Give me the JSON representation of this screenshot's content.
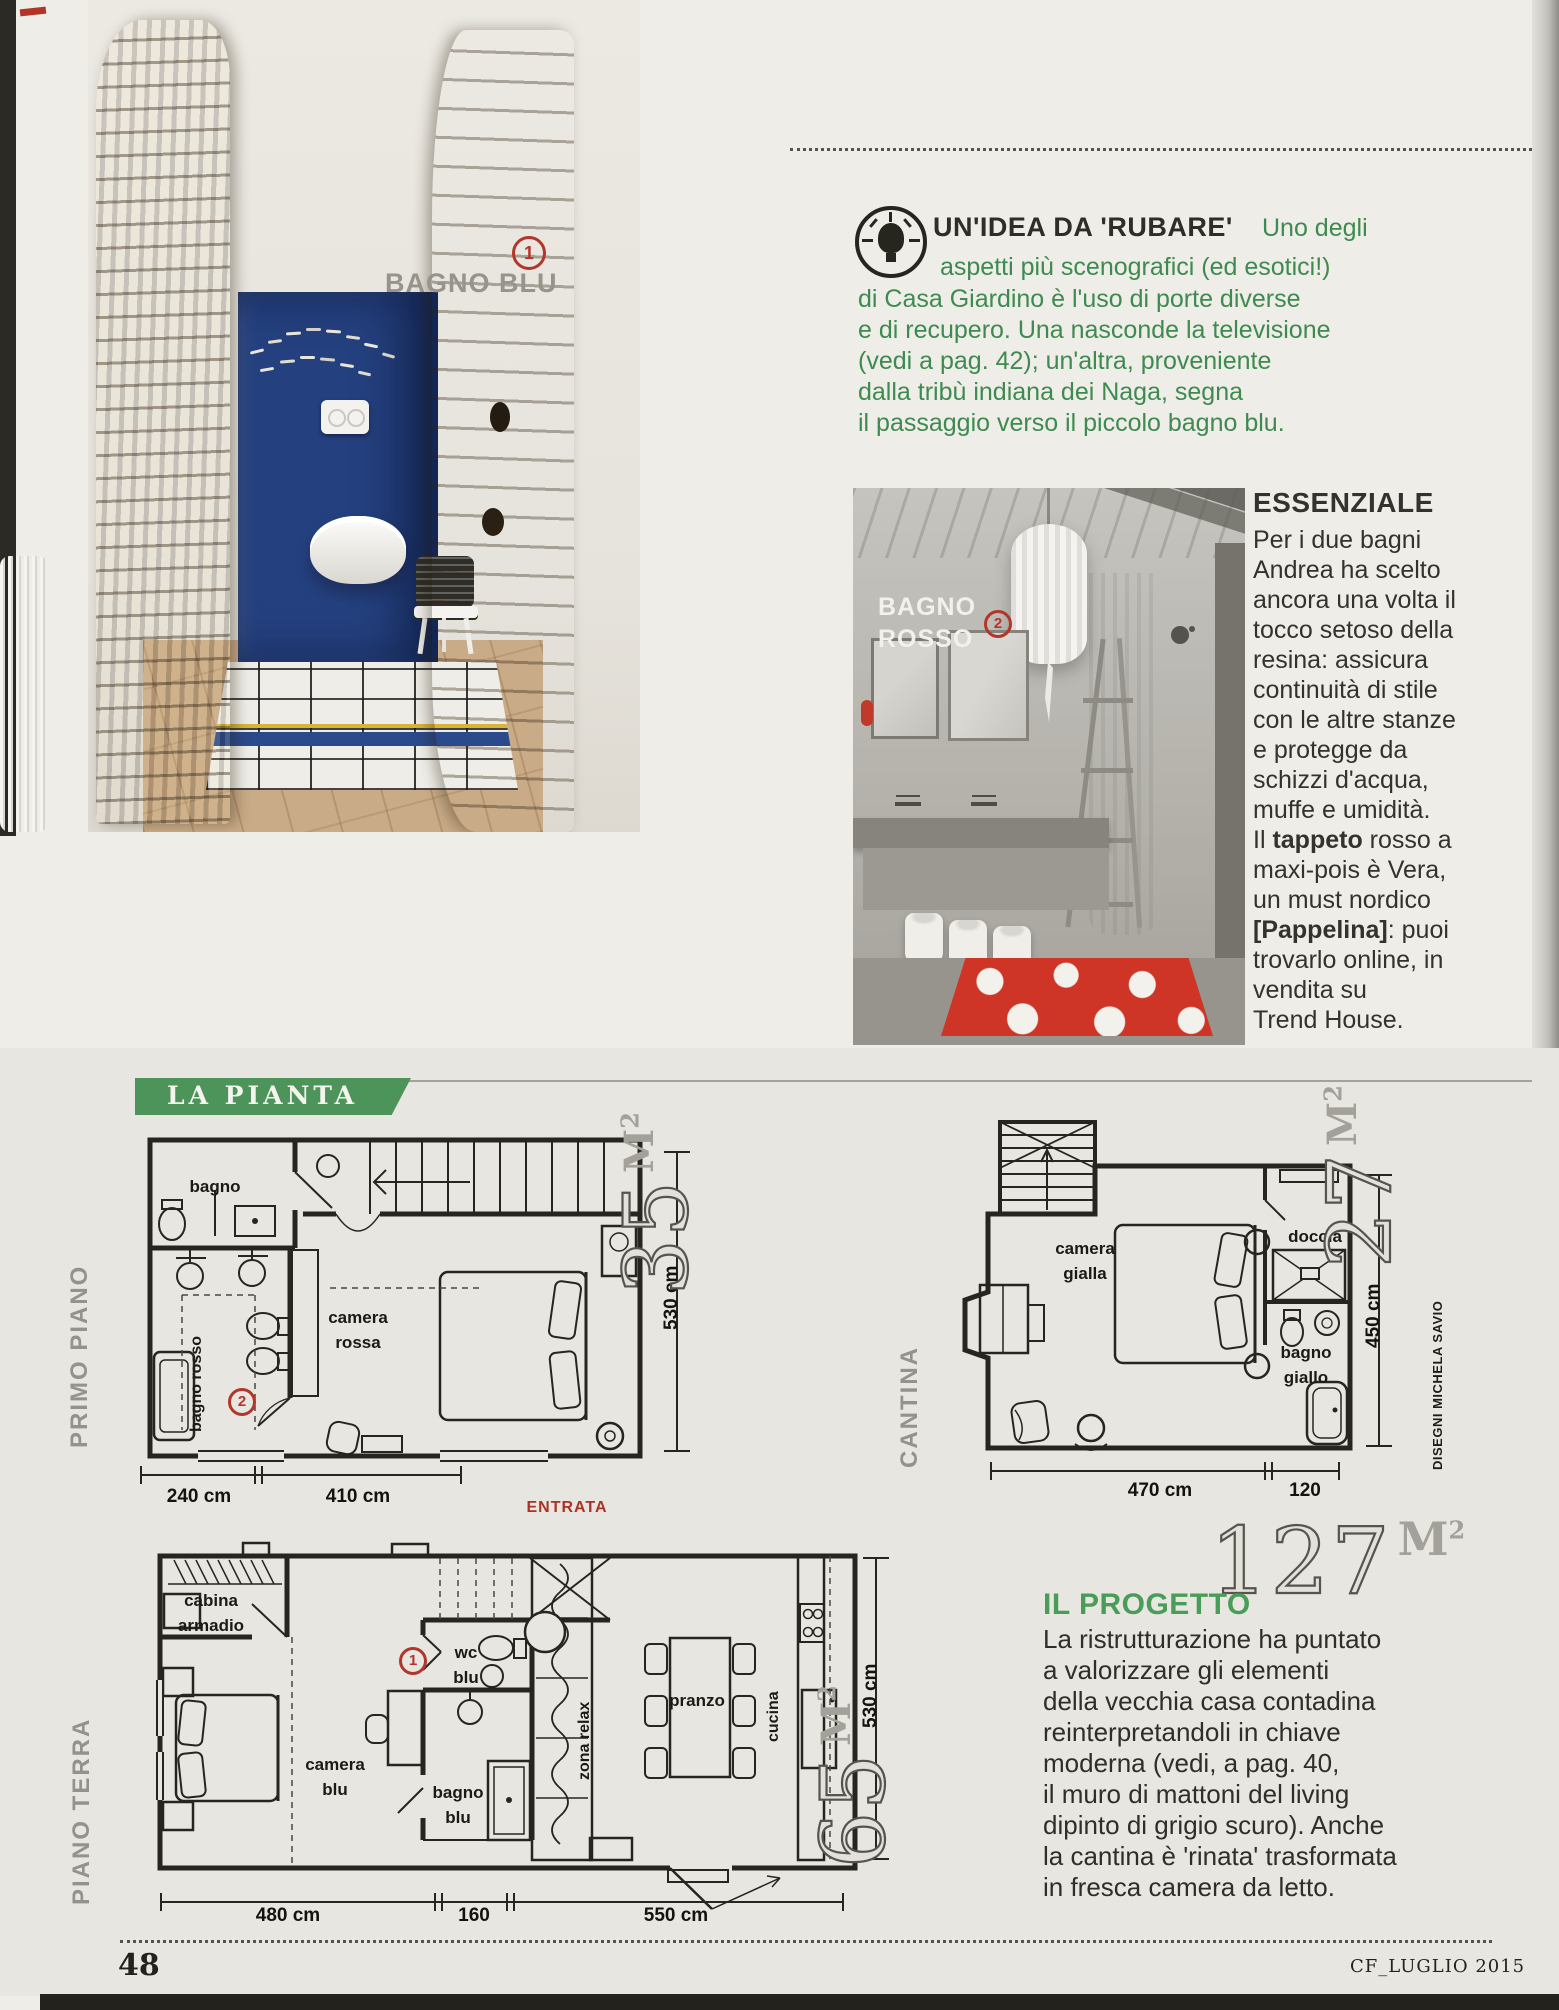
{
  "colors": {
    "accent_green": "#3e8a50",
    "banner_green": "#4c9459",
    "badge_red": "#b3362a",
    "rug_red": "#d23726",
    "blue_wall": "#24407e"
  },
  "page": {
    "number": "48",
    "footer_right": "CF_LUGLIO 2015"
  },
  "units": {
    "m": "M",
    "sup": "2"
  },
  "photo_blu": {
    "badge": "1",
    "label": "BAGNO BLU"
  },
  "tip": {
    "title": "UN'IDEA DA 'RUBARE'",
    "lines": [
      "Uno degli",
      "aspetti più scenografici (ed esotici!)",
      "di Casa Giardino è l'uso di porte diverse",
      "e di recupero. Una nasconde la televisione",
      "(vedi a pag. 42); un'altra, proveniente",
      "dalla tribù indiana dei Naga, segna",
      "il passaggio verso il piccolo bagno blu."
    ]
  },
  "photo_rosso": {
    "badge": "2",
    "label1": "BAGNO",
    "label2": "ROSSO"
  },
  "essenziale": {
    "title": "ESSENZIALE",
    "lines_a": [
      "Per i due bagni",
      "Andrea ha scelto",
      "ancora una volta il",
      "tocco setoso della",
      "resina: assicura",
      "continuità di stile",
      "con le altre stanze",
      "e protegge da",
      "schizzi d'acqua,",
      "muffe e umidità."
    ],
    "tappeto_pre": "Il ",
    "tappeto_bold": "tappeto",
    "tappeto_post": " rosso a",
    "lines_b": [
      "maxi-pois è Vera,",
      "un must nordico"
    ],
    "pappelina_bold": "[Pappelina]",
    "pappelina_post": ": puoi",
    "lines_c": [
      "trovarlo online, in",
      "vendita su",
      "Trend House."
    ]
  },
  "pianta": {
    "banner": "LA PIANTA"
  },
  "primo_piano": {
    "floor_label": "PRIMO PIANO",
    "area": "35",
    "badge": "2",
    "room_bagno": "bagno",
    "room_camera_l1": "camera",
    "room_camera_l2": "rossa",
    "room_bagno_rosso": "bagno rosso",
    "dim_w1": "240 cm",
    "dim_w2": "410 cm",
    "dim_h": "530 cm"
  },
  "cantina": {
    "floor_label": "CANTINA",
    "area": "27",
    "room_camera_l1": "camera",
    "room_camera_l2": "gialla",
    "room_doccia": "doccia",
    "room_bagno_l1": "bagno",
    "room_bagno_l2": "giallo",
    "dim_w1": "470 cm",
    "dim_w2": "120",
    "dim_h": "450 cm"
  },
  "piano_terra": {
    "floor_label": "PIANO TERRA",
    "area": "65",
    "badge": "1",
    "entrata": "ENTRATA",
    "room_cabina_l1": "cabina",
    "room_cabina_l2": "armadio",
    "room_camera_l1": "camera",
    "room_camera_l2": "blu",
    "room_wc_l1": "wc",
    "room_wc_l2": "blu",
    "room_bagno_l1": "bagno",
    "room_bagno_l2": "blu",
    "room_zona": "zona relax",
    "room_pranzo": "pranzo",
    "room_cucina": "cucina",
    "dim_w1": "480 cm",
    "dim_w2": "160",
    "dim_w3": "550 cm",
    "dim_h": "530 cm"
  },
  "credit": "DISEGNI MICHELA SAVIO",
  "progetto": {
    "area": "127",
    "title": "IL PROGETTO",
    "lines": [
      "La ristrutturazione ha puntato",
      "a valorizzare gli elementi",
      "della vecchia casa contadina",
      "reinterpretandoli in chiave",
      "moderna (vedi, a pag. 40,",
      "il muro di mattoni del living",
      "dipinto di grigio scuro). Anche",
      "la cantina è 'rinata' trasformata",
      "in fresca camera da letto."
    ]
  }
}
